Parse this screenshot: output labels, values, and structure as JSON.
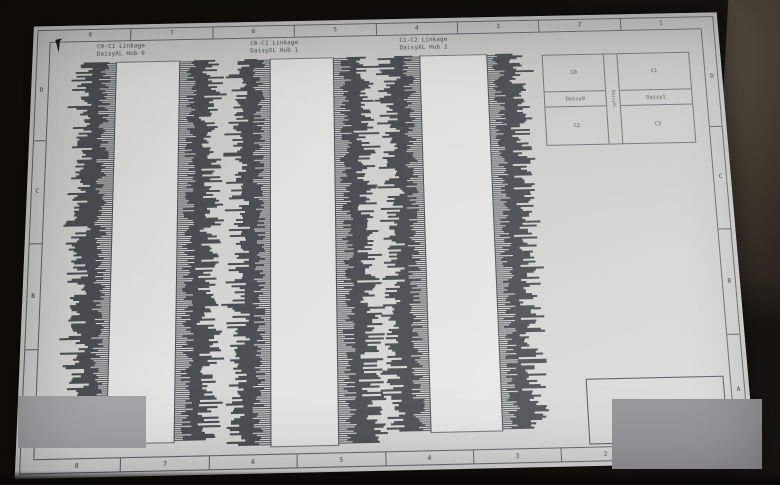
{
  "sheet": {
    "ruler_top": [
      "8",
      "7",
      "6",
      "5",
      "4",
      "3",
      "2",
      "1"
    ],
    "ruler_bottom": [
      "8",
      "7",
      "6",
      "5",
      "4",
      "3",
      "2",
      "1"
    ],
    "ruler_left": [
      "D",
      "C",
      "B",
      "A"
    ],
    "ruler_right": [
      "D",
      "C",
      "B",
      "A"
    ]
  },
  "blocks": [
    {
      "title_line1": "C0-C1 Linkage",
      "title_line2": "DaisyXL Hub 0",
      "pins_per_side": 190
    },
    {
      "title_line1": "C0-C1 Linkage",
      "title_line2": "DaisyXL Hub 1",
      "pins_per_side": 193
    },
    {
      "title_line1": "C1-C2 Linkage",
      "title_line2": "DaisyXL Hub 2",
      "pins_per_side": 188
    }
  ],
  "legend_table": {
    "top_left": "C0",
    "top_right": "C1",
    "mid_left": "Daisy0",
    "mid_right": "Daisy1",
    "mid_center_vertical": "DaisyXL",
    "bottom_left": "C2",
    "bottom_right": "C3"
  },
  "icons": {
    "cursor": "arrow-pointer-icon"
  },
  "colors": {
    "paper": "#d8d9d7",
    "line": "#6a6d70",
    "pin_ink": "#43474c",
    "redaction_grey": "#a4a4a6",
    "bezel_black": "#14120e",
    "case_brown": "#4c4337"
  }
}
